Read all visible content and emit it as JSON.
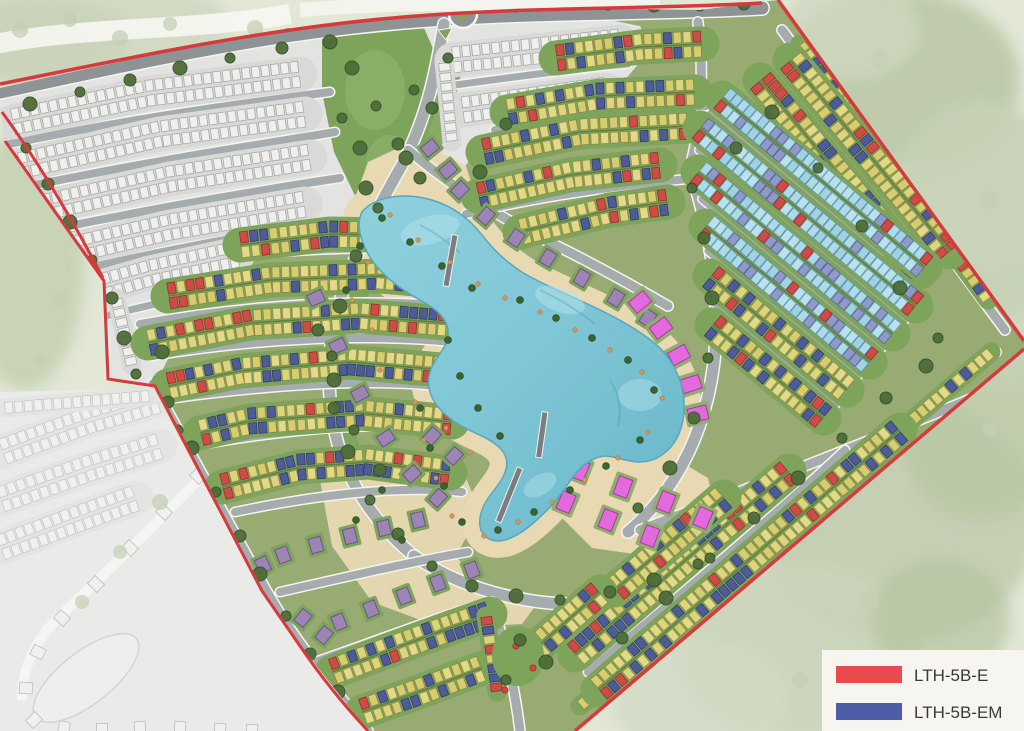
{
  "legend": {
    "items": [
      {
        "id": "lth-5b-e",
        "label": "LTH-5B-E",
        "color": "#e84a4e"
      },
      {
        "id": "lth-5b-em",
        "label": "LTH-5B-EM",
        "color": "#4d5ea6"
      }
    ]
  },
  "palette": {
    "boundary": "#d63a3c",
    "outside": "#e2e7d6",
    "grass": "#97ab72",
    "garden": "#7da45a",
    "hedge": "#5a7d3f",
    "park": "#7da45a",
    "sand": "#e8d9b2",
    "water": "#7fc6d6",
    "water_deep": "#5fb0c4",
    "water_light": "#b4e3eb",
    "road": "#a6abad",
    "road_major": "#8e9396",
    "road_edge": "#f4f4f1",
    "tree": "#4e6c38",
    "tree_rim": "#35522a",
    "palm": "#3a6531",
    "umbrella": "#d1955e",
    "unit_yellow": "#ddd47b",
    "unit_blue": "#4f5b96",
    "unit_red": "#cf4b46",
    "unit_cyan": "#aedbe8",
    "unit_lavender": "#8f9ac8",
    "unit_gray": "#efefed",
    "villa_purple": "#9c84b4",
    "villa_pink": "#e26ade",
    "washed_area": "#eaeae8",
    "gray_area": "#e3e3e1",
    "legend_bg": "#f7f5ef",
    "legend_text": "#3a3a3a"
  }
}
